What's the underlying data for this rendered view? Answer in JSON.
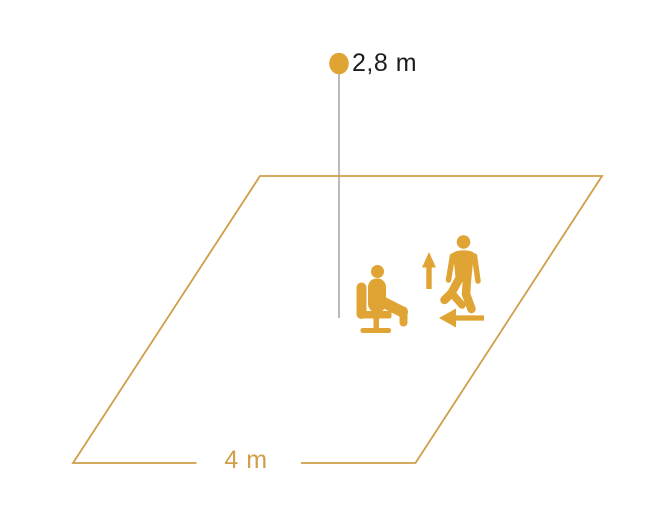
{
  "diagram": {
    "height_label": "2,8 m",
    "width_label": "4 m",
    "height_value_m": 2.8,
    "width_value_m": 4
  },
  "icons": [
    {
      "name": "sensor-dot",
      "meaning": "ceiling-mounted presence sensor"
    },
    {
      "name": "seated-person-icon",
      "meaning": "seated occupant on office chair"
    },
    {
      "name": "walking-person-icon",
      "meaning": "walking occupant"
    },
    {
      "name": "up-arrow-icon",
      "meaning": "movement direction up / toward sensor"
    },
    {
      "name": "left-arrow-icon",
      "meaning": "movement direction left / across area"
    }
  ],
  "colors": {
    "icon_orange": "#E0A435",
    "outline_orange": "#D09E48",
    "height_line_gray": "#8C8C8C",
    "label_dark": "#1D1D1B",
    "background": "#FFFFFF"
  }
}
